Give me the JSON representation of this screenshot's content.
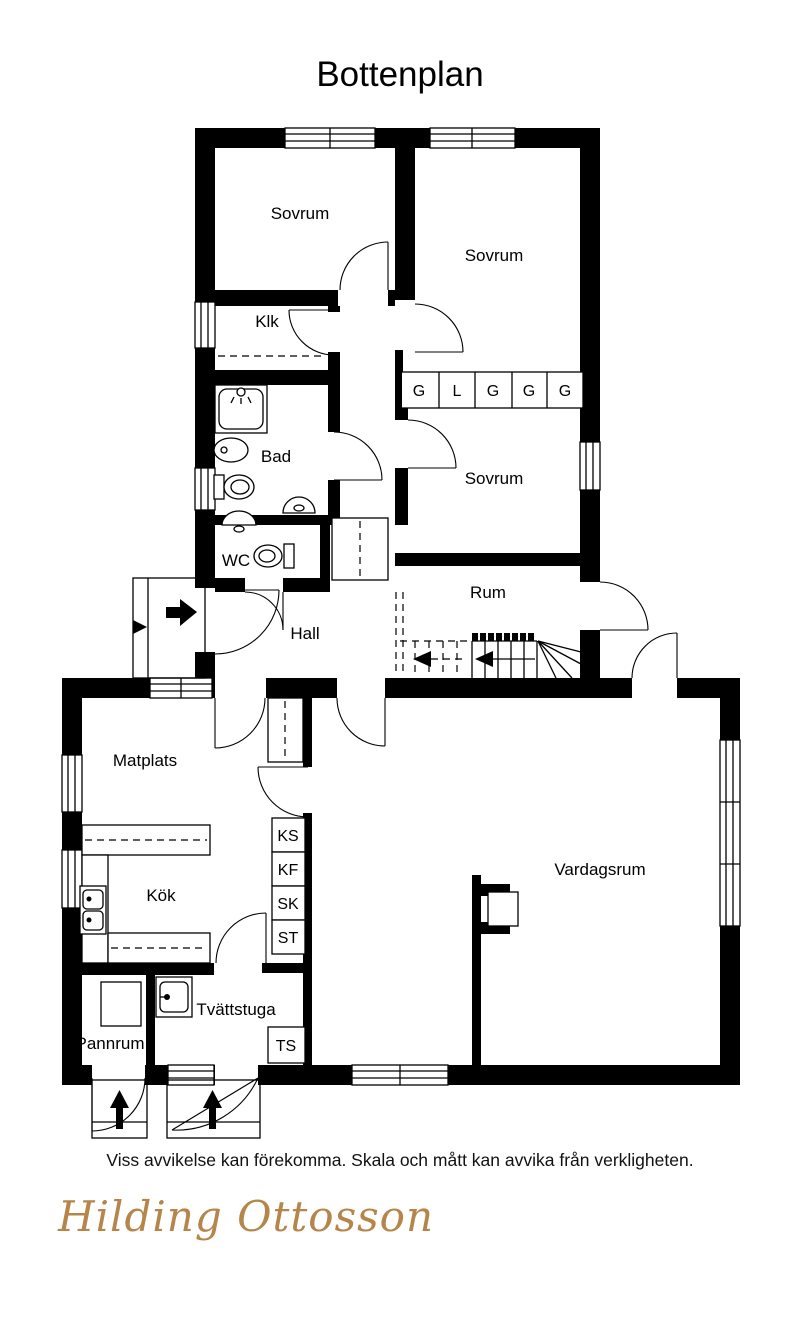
{
  "title": "Bottenplan",
  "rooms": {
    "sovrum1": {
      "label": "Sovrum"
    },
    "sovrum2": {
      "label": "Sovrum"
    },
    "sovrum3": {
      "label": "Sovrum"
    },
    "klk": {
      "label": "Klk"
    },
    "bad": {
      "label": "Bad"
    },
    "wc": {
      "label": "WC"
    },
    "hall": {
      "label": "Hall"
    },
    "rum": {
      "label": "Rum"
    },
    "matplats": {
      "label": "Matplats"
    },
    "kok": {
      "label": "Kök"
    },
    "vardagsrum": {
      "label": "Vardagsrum"
    },
    "pannrum": {
      "label": "Pannrum"
    },
    "tvattstuga": {
      "label": "Tvättstuga"
    }
  },
  "wardrobes": {
    "u1": "G",
    "u2": "L",
    "u3": "G",
    "u4": "G",
    "u5": "G"
  },
  "appliances": {
    "ks": "KS",
    "kf": "KF",
    "sk": "SK",
    "st": "ST",
    "ts": "TS"
  },
  "footer": {
    "disclaimer": "Viss avvikelse kan förekomma. Skala och mått kan avvika från verkligheten.",
    "logo_text": "Hilding Ottosson"
  },
  "colors": {
    "walls": "#000000",
    "background": "#ffffff",
    "logo_gold": "#b5854a"
  }
}
